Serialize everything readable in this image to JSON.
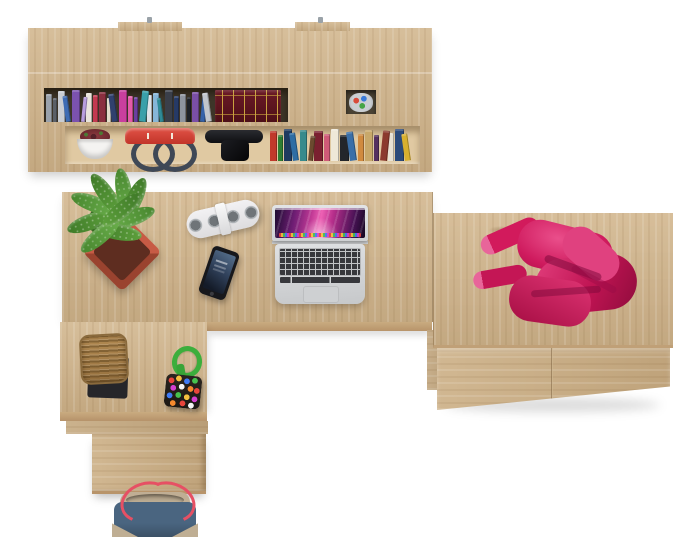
{
  "image": {
    "type": "furniture product render, top-down view",
    "description": "Top-down view of a home office corner desk with wall shelf, side cabinet, laptop and accessories",
    "background_color": "#ffffff"
  },
  "furniture": {
    "wall_shelf": {
      "label": "Wall shelf with two rows of books",
      "wood_color": "#d2b78f",
      "bracket_color": "#9aa2a8",
      "bracket_count": 2
    },
    "desk": {
      "label": "L-shaped corner desk",
      "wood_color": "#d2b78f"
    },
    "pedestal": {
      "label": "Under-desk pedestal",
      "wood_color": "#cdb188"
    },
    "cabinet": {
      "label": "Low side cabinet with two drawers",
      "wood_color": "#d2b78f",
      "drawer_count": 2
    }
  },
  "shelf_items": {
    "row1_books": [
      "#9aa2ac",
      "#5a6068",
      "#c9cdd3",
      "#3e6cb4",
      "#7b52ae",
      "#b89ede",
      "#e9e5db",
      "#c23a50",
      "#8a2f3f",
      "#e3dccb",
      "#30406e",
      "#c93f9e",
      "#e35aa8",
      "#6a3f9e",
      "#3aa0aa",
      "#dfe3e8",
      "#86b6d8",
      "#2f8a96",
      "#3a3f4a",
      "#263a66",
      "#8e949e",
      "#1e2228",
      "#7a4fa6",
      "#3562a8",
      "#c2c6cc"
    ],
    "antique_book_set": {
      "label": "Dark red antique book set with gold ornament",
      "color": "#5c1420",
      "accent_color": "#c9a23f"
    },
    "pencil_cup": {
      "label": "Pencil cup",
      "cup_color": "#caced2",
      "pencil_colors": [
        "#d84b3a",
        "#3a7bd8",
        "#46a546"
      ]
    },
    "plant_cup": {
      "label": "White cup with dark-red succulent",
      "cup_color": "#f4f3f1",
      "plant_color": "#8c3a40"
    },
    "handbag": {
      "label": "Red handbag with dark handles",
      "body_color": "#d8433a",
      "handle_color": "#3f4856"
    },
    "headphones": {
      "label": "Black headphones",
      "color": "#141518"
    },
    "row2_books": [
      "#c0392b",
      "#2e7d32",
      "#1f3a5f",
      "#2e6da4",
      "#378a8c",
      "#6b4a2f",
      "#7a2030",
      "#cf5a78",
      "#efe8d8",
      "#23262b",
      "#3a6fa8",
      "#d08a3f",
      "#c8a86a",
      "#55305f",
      "#8c3a2e",
      "#e8e2d4",
      "#2b4a7a",
      "#d8b02f"
    ]
  },
  "desk_items": {
    "plant": {
      "label": "Green potted plant in red square planter",
      "pot_color": "#b5503c",
      "leaf_colors": [
        "#3f7a28",
        "#47862e",
        "#5da03c",
        "#6aae4b"
      ]
    },
    "speaker": {
      "label": "White portable speaker with four grills",
      "body_color": "#ebebed",
      "grill_color": "#6f7478",
      "grill_count": 4
    },
    "phone": {
      "label": "Black smartphone with lock screen",
      "body_color": "#17181c",
      "screen_color": "#31425c"
    },
    "laptop": {
      "label": "Silver laptop with purple aurora wallpaper",
      "body_color": "#d6d8da",
      "key_color": "#37383c",
      "screen_colors": [
        "#ed61b4",
        "#c23a96",
        "#6f1e74",
        "#140822"
      ],
      "dock_colors": [
        "#e8453c",
        "#f5c03f",
        "#46c24e",
        "#3f7bf5",
        "#d43fd0"
      ]
    },
    "basket": {
      "label": "Brown wicker basket on black mat",
      "basket_color": "#a8824e",
      "mat_color": "#26262a"
    },
    "bead_toy": {
      "label": "Beaded pouch with green cord",
      "cord_color": "#3cae3c",
      "bead_colors": [
        "#e8453c",
        "#f5c03f",
        "#3f7bf5",
        "#46c24e",
        "#d43fd0",
        "#f5f5f5",
        "#f58a2e"
      ]
    }
  },
  "cabinet_items": {
    "sweater": {
      "label": "Crumpled pink sweater",
      "color": "#d21a5c",
      "highlight_color": "#e8659a",
      "shadow_color": "#8f0c3c"
    }
  },
  "floor_items": {
    "tote_bag": {
      "label": "Blue canvas tote bag with red straps",
      "body_color": "#4a6580",
      "trim_color": "#c0ae94",
      "strap_color": "#e65064"
    }
  }
}
